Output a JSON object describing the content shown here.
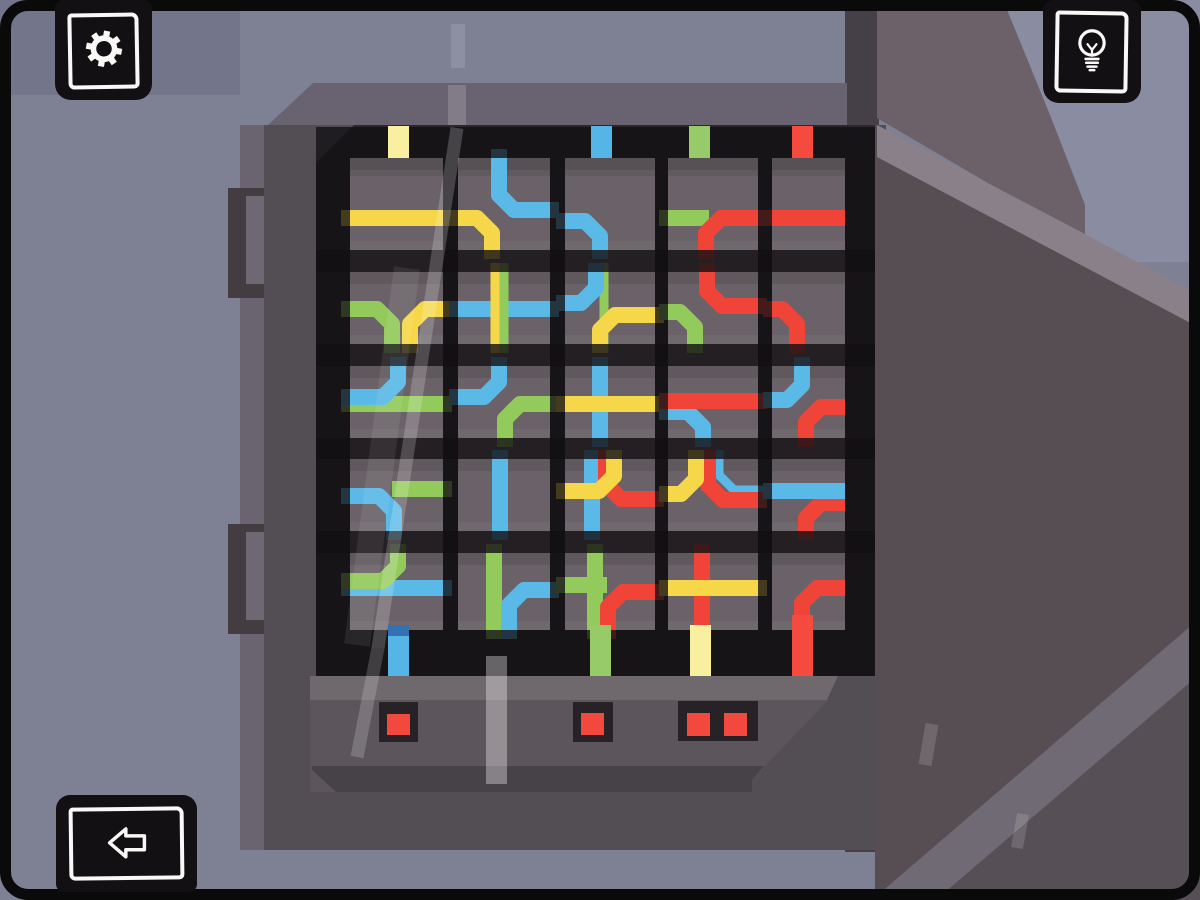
{
  "app": {
    "name": "wire-puzzle-fusebox-screen",
    "visible_text": []
  },
  "palette": {
    "wall": "#7E8094",
    "wallTopLeft": "#73758A",
    "wallCorner": "#8A8CA2",
    "boxTop": "#696371",
    "boxFace": "#534D54",
    "boxLeftBand": "#69646F",
    "boxRightShadow": "#454047",
    "hingeOuter": "#433C40",
    "hingeInner": "#6E6874",
    "bezel": "#2B272B",
    "strip": "#6A6268",
    "panelTop": "#6F686D",
    "panelMid": "#5C565C",
    "panelLow": "#474148",
    "doorUpper": "#6C6168",
    "doorEdge": "#8A8089",
    "doorFace": "#574E53",
    "doorBandLow": "#6F6A73",
    "doorCornerLow": "#565056",
    "housing": "#272226",
    "led": "#F2483D",
    "wire": {
      "Y": "#F6D74A",
      "B": "#5BB9E8",
      "G": "#93CA5C",
      "R": "#F04438"
    },
    "stubYellow": "#F8EFA0",
    "stubBlue": "#55B5E6",
    "stubGreen": "#97CB6A",
    "stubRed": "#F54A3E",
    "stubBlueCap": "#3470B4"
  },
  "buttons": {
    "settings": {
      "icon": "gear-icon"
    },
    "hint": {
      "icon": "lightbulb-icon"
    },
    "back": {
      "icon": "back-arrow-icon"
    }
  },
  "scene": {
    "back": [
      {
        "name": "wall",
        "rect": [
          0,
          0,
          1200,
          900
        ],
        "fill": "wall"
      },
      {
        "name": "wall-top-left-shade",
        "rect": [
          0,
          0,
          240,
          95
        ],
        "fill": "wallTopLeft"
      },
      {
        "name": "wall-corner-light",
        "poly": "1003,0 1200,0 1200,262 1085,262 1085,205 1050,115",
        "fill": "wallCorner"
      },
      {
        "name": "box-right-shadow",
        "rect": [
          845,
          0,
          34,
          852
        ],
        "fill": "boxRightShadow"
      },
      {
        "name": "box-top-face",
        "poly": "268,125 313,83 847,83 847,125",
        "fill": "boxTop"
      },
      {
        "name": "box-left-band",
        "rect": [
          240,
          125,
          26,
          725
        ],
        "fill": "boxLeftBand"
      },
      {
        "name": "hinge1-outer",
        "rect": [
          228,
          188,
          50,
          110
        ],
        "fill": "hingeOuter"
      },
      {
        "name": "hinge1-inner",
        "rect": [
          246,
          196,
          26,
          88
        ],
        "fill": "hingeInner"
      },
      {
        "name": "hinge2-outer",
        "rect": [
          228,
          524,
          50,
          110
        ],
        "fill": "hingeOuter"
      },
      {
        "name": "hinge2-inner",
        "rect": [
          246,
          532,
          26,
          88
        ],
        "fill": "hingeInner"
      },
      {
        "name": "box-face",
        "rect": [
          264,
          125,
          622,
          725
        ],
        "fill": "boxFace"
      },
      {
        "name": "bezel",
        "rect": [
          316,
          125,
          559,
          551
        ],
        "fill": "bezel"
      },
      {
        "name": "bezel-corner-bevel",
        "poly": "316,125 354,125 316,163",
        "fill": "boxFace"
      }
    ],
    "front": [
      {
        "name": "panel-top-strip",
        "poly": "310,676 838,676 826,702 310,702",
        "fill": "panelTop"
      },
      {
        "name": "panel-mid",
        "poly": "310,700 828,700 752,780 752,792 310,792",
        "fill": "panelMid"
      },
      {
        "name": "panel-low",
        "poly": "312,766 764,766 752,780 752,792 336,792 312,770",
        "fill": "panelLow"
      },
      {
        "name": "door-upper",
        "poly": "877,0 1003,0 1050,115 1085,205 1085,240 877,118",
        "fill": "doorUpper"
      },
      {
        "name": "door-face",
        "poly": "875,148 1200,323 1200,900 875,900",
        "fill": "doorFace"
      },
      {
        "name": "door-edge-band",
        "poly": "877,125 1085,234 1200,296 1200,328 877,157",
        "fill": "doorEdge"
      },
      {
        "name": "door-band-low",
        "poly": "872,900 1200,618 1200,674 936,900",
        "fill": "doorBandLow"
      },
      {
        "name": "door-corner-low",
        "poly": "936,900 1200,674 1200,900",
        "fill": "doorCornerLow"
      }
    ]
  },
  "fusebox": {
    "grid": {
      "top": 158,
      "bottom": 630,
      "left": 316,
      "right": 875
    },
    "rows": [
      {
        "t": 158,
        "b": 250,
        "y": 218
      },
      {
        "t": 272,
        "b": 344,
        "y": 309
      },
      {
        "t": 366,
        "b": 438,
        "y": 404
      },
      {
        "t": 459,
        "b": 531,
        "y": 496
      },
      {
        "t": 553,
        "b": 630,
        "y": 588
      }
    ],
    "cols": [
      {
        "x": 350,
        "w": 93,
        "wx": 398
      },
      {
        "x": 458,
        "w": 92,
        "wx": 500
      },
      {
        "x": 565,
        "w": 90,
        "wx": 601
      },
      {
        "x": 668,
        "w": 90,
        "wx": 703
      },
      {
        "x": 772,
        "w": 73,
        "wx": 802,
        "noExtR": true
      }
    ],
    "cells": [
      [
        [
          {
            "c": "Y",
            "s": "h"
          }
        ],
        [
          {
            "c": "G",
            "s": "bl",
            "x": 392
          },
          {
            "c": "Y",
            "s": "br",
            "x": 410
          }
        ],
        [
          {
            "c": "G",
            "s": "h"
          },
          {
            "c": "B",
            "s": "tl",
            "x": 398,
            "dy": -7
          }
        ],
        [
          {
            "c": "G",
            "s": "hr",
            "dy": -7
          },
          {
            "c": "B",
            "s": "bl",
            "x": 394
          }
        ],
        [
          {
            "c": "B",
            "s": "h"
          },
          {
            "c": "G",
            "s": "tl",
            "x": 398,
            "dy": -7
          }
        ]
      ],
      [
        [
          {
            "c": "B",
            "s": "tr",
            "x": 499,
            "dy": -8
          },
          {
            "c": "Y",
            "s": "bl",
            "x": 492
          }
        ],
        [
          {
            "c": "B",
            "s": "h"
          },
          {
            "c": "Y",
            "s": "v",
            "x": 495,
            "w": 9
          },
          {
            "c": "G",
            "s": "v",
            "x": 504,
            "w": 9
          }
        ],
        [
          {
            "c": "B",
            "s": "tl",
            "x": 499,
            "dy": -7
          },
          {
            "c": "G",
            "s": "br",
            "x": 505
          }
        ],
        [
          {
            "c": "B",
            "s": "v",
            "x": 500
          }
        ],
        [
          {
            "c": "G",
            "s": "v",
            "x": 494
          },
          {
            "c": "B",
            "s": "br",
            "x": 509,
            "dy": 2
          }
        ]
      ],
      [
        [
          {
            "c": "B",
            "s": "bl",
            "x": 600,
            "dy": 3
          }
        ],
        [
          {
            "c": "G",
            "s": "v",
            "x": 604,
            "w": 9
          },
          {
            "c": "B",
            "s": "tl",
            "x": 596,
            "dy": -6
          },
          {
            "c": "Y",
            "s": "br",
            "x": 600,
            "dy": 6
          }
        ],
        [
          {
            "c": "B",
            "s": "v",
            "x": 600
          },
          {
            "c": "Y",
            "s": "h"
          }
        ],
        [
          {
            "c": "B",
            "s": "v",
            "x": 592
          },
          {
            "c": "R",
            "s": "tr",
            "x": 606,
            "dy": 3
          },
          {
            "c": "Y",
            "s": "tl",
            "x": 614,
            "dy": -5
          }
        ],
        [
          {
            "c": "G",
            "s": "v",
            "x": 595
          },
          {
            "c": "G",
            "s": "hl",
            "dy": -3
          },
          {
            "c": "R",
            "s": "br",
            "x": 608,
            "dy": 4
          }
        ]
      ],
      [
        [
          {
            "c": "G",
            "s": "hl"
          },
          {
            "c": "R",
            "s": "br",
            "x": 706
          }
        ],
        [
          {
            "c": "G",
            "s": "bl",
            "x": 695,
            "dy": 3
          },
          {
            "c": "R",
            "s": "tr",
            "x": 707,
            "dy": -3
          }
        ],
        [
          {
            "c": "B",
            "s": "bl",
            "x": 703,
            "dy": 8
          },
          {
            "c": "R",
            "s": "h",
            "dy": -3
          }
        ],
        [
          {
            "c": "B",
            "s": "tr",
            "x": 719,
            "dy": -6,
            "w": 9
          },
          {
            "c": "R",
            "s": "tr",
            "x": 708,
            "dy": 4
          },
          {
            "c": "Y",
            "s": "tl",
            "x": 696,
            "dy": -2
          }
        ],
        [
          {
            "c": "R",
            "s": "v",
            "x": 702
          },
          {
            "c": "Y",
            "s": "h"
          }
        ]
      ],
      [
        [
          {
            "c": "R",
            "s": "h"
          }
        ],
        [
          {
            "c": "R",
            "s": "bl",
            "x": 797
          }
        ],
        [
          {
            "c": "R",
            "s": "br",
            "x": 806,
            "dy": 3
          },
          {
            "c": "B",
            "s": "tl",
            "x": 802,
            "dy": -4
          }
        ],
        [
          {
            "c": "R",
            "s": "br",
            "x": 806,
            "dy": 7
          },
          {
            "c": "B",
            "s": "h",
            "dy": -5
          }
        ],
        [
          {
            "c": "R",
            "s": "br",
            "x": 802
          }
        ]
      ]
    ],
    "topStubs": [
      {
        "x": 388,
        "color": "stubYellow"
      },
      {
        "x": 591,
        "color": "stubBlue"
      },
      {
        "x": 689,
        "color": "stubGreen"
      },
      {
        "x": 792,
        "color": "stubRed"
      }
    ],
    "bottomStubs": [
      {
        "x": 388,
        "color": "stubBlue",
        "cap": "stubBlueCap"
      },
      {
        "x": 590,
        "color": "stubGreen",
        "tip": {
          "x": 600,
          "w": 16,
          "color": "R"
        }
      },
      {
        "x": 690,
        "color": "stubYellow",
        "tip": {
          "x": 694,
          "w": 16,
          "color": "R"
        }
      },
      {
        "x": 792,
        "color": "stubRed",
        "tall": true
      }
    ],
    "wireTips": [
      {
        "x": 490,
        "w": 9,
        "color": "G"
      },
      {
        "x": 504,
        "w": 9,
        "color": "B"
      }
    ],
    "indicators": [
      {
        "x": 379,
        "y": 702,
        "w": 39,
        "h": 40,
        "leds": [
          {
            "x": 387,
            "y": 714,
            "w": 23,
            "h": 21
          }
        ]
      },
      {
        "x": 573,
        "y": 702,
        "w": 40,
        "h": 40,
        "leds": [
          {
            "x": 581,
            "y": 713,
            "w": 23,
            "h": 22
          }
        ]
      },
      {
        "x": 678,
        "y": 701,
        "w": 80,
        "h": 40,
        "leds": [
          {
            "x": 687,
            "y": 713,
            "w": 23,
            "h": 23
          },
          {
            "x": 724,
            "y": 713,
            "w": 23,
            "h": 23
          }
        ]
      }
    ]
  },
  "reflections": [
    {
      "type": "rect",
      "x": 451,
      "y": 24,
      "w": 14,
      "h": 44,
      "o": 0.13
    },
    {
      "type": "rect",
      "x": 448,
      "y": 85,
      "w": 18,
      "h": 40,
      "o": 0.16
    },
    {
      "type": "line",
      "x1": 457,
      "y1": 128,
      "x2": 378,
      "y2": 648,
      "w": 13,
      "o": 0.2
    },
    {
      "type": "line",
      "x1": 378,
      "y1": 648,
      "x2": 357,
      "y2": 757,
      "w": 13,
      "o": 0.18
    },
    {
      "type": "line",
      "x1": 407,
      "y1": 268,
      "x2": 357,
      "y2": 645,
      "w": 26,
      "o": 0.08
    },
    {
      "type": "rect",
      "x": 486,
      "y": 656,
      "w": 21,
      "h": 128,
      "o": 0.34
    },
    {
      "type": "line",
      "x1": 932,
      "y1": 724,
      "x2": 925,
      "y2": 765,
      "w": 13,
      "o": 0.14
    },
    {
      "type": "line",
      "x1": 1023,
      "y1": 814,
      "x2": 1017,
      "y2": 848,
      "w": 12,
      "o": 0.14
    }
  ]
}
